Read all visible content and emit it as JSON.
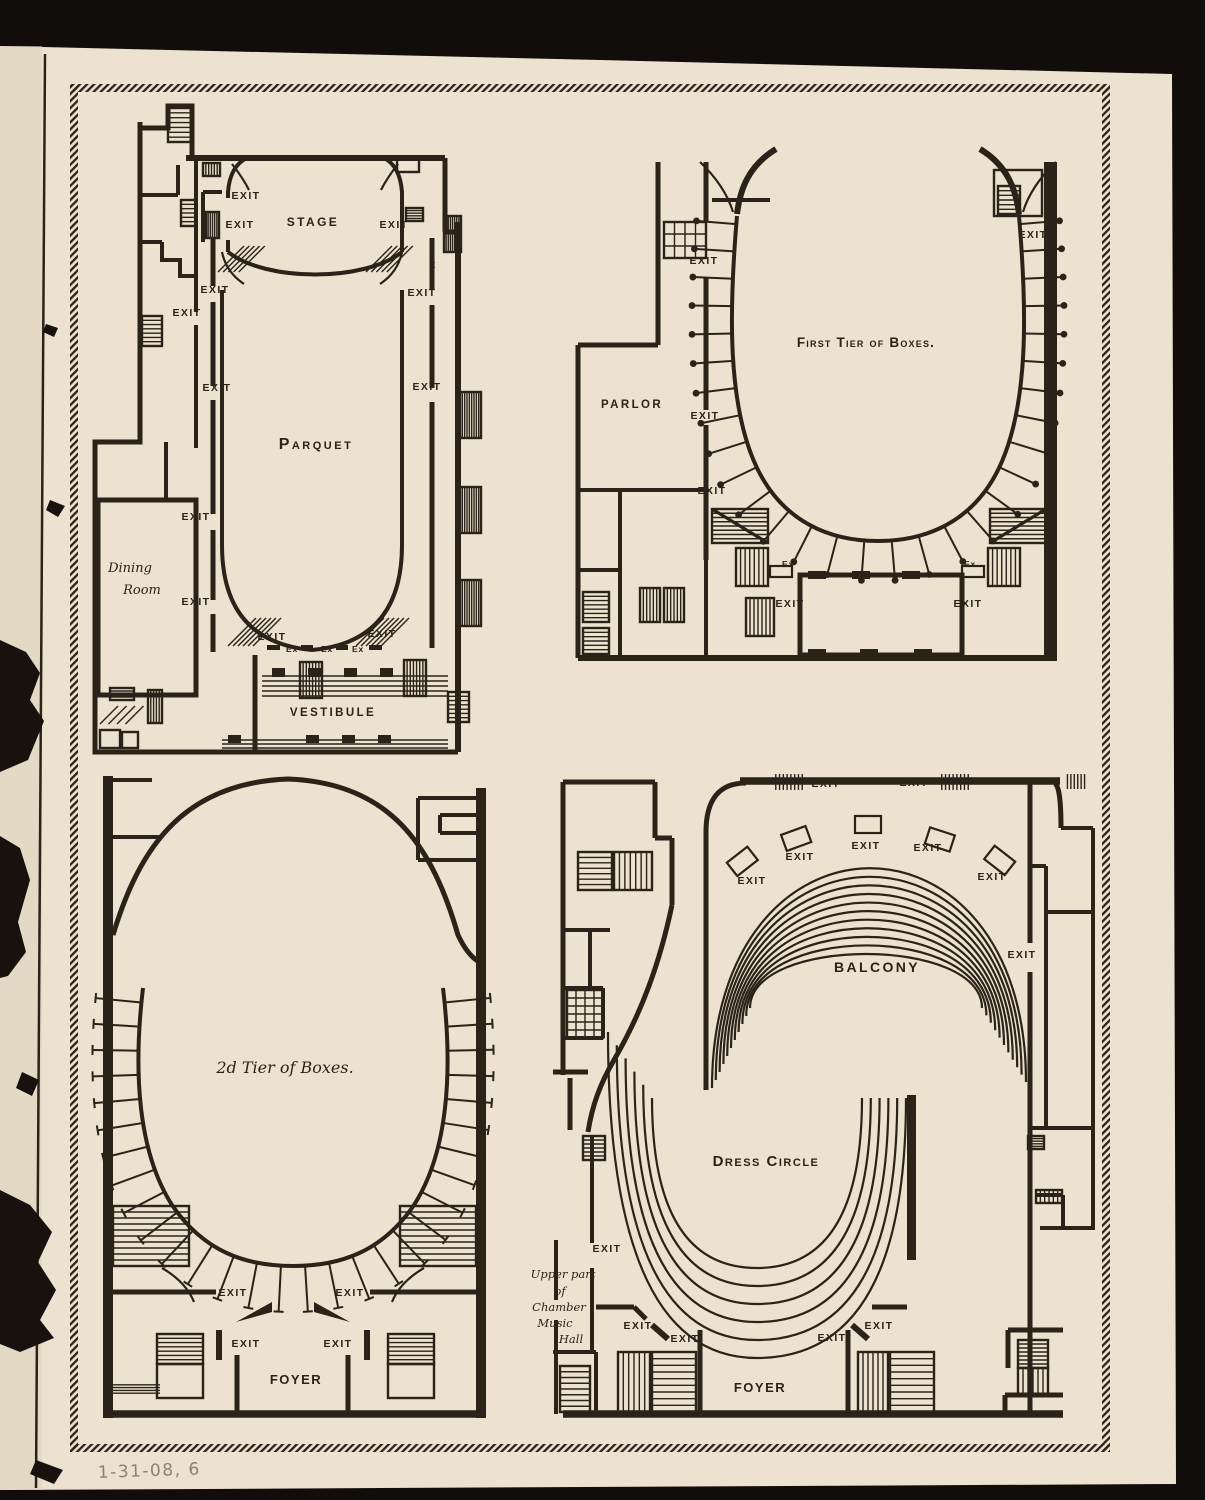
{
  "colors": {
    "paper": "#ece2cf",
    "ink": "#2b221a",
    "background": "#100d0b",
    "pencil": "#8d8172"
  },
  "labels": {
    "exit": "EXIT",
    "ex": "Ex",
    "e": "E"
  },
  "plans": {
    "parquet": {
      "stage": "STAGE",
      "name": "Parquet",
      "dining_line1": "Dining",
      "dining_line2": "Room",
      "vestibule": "VESTIBULE"
    },
    "first_tier": {
      "name": "First Tier of Boxes.",
      "parlor": "PARLOR"
    },
    "second_tier": {
      "name": "2d Tier of Boxes.",
      "foyer": "FOYER"
    },
    "balcony": {
      "name": "BALCONY",
      "dress_circle": "Dress Circle",
      "foyer": "FOYER",
      "chamber": [
        "Upper part",
        "of",
        "Chamber",
        "Music",
        "Hall"
      ]
    }
  },
  "annotation": {
    "date_note": "1-31-08, 6"
  }
}
